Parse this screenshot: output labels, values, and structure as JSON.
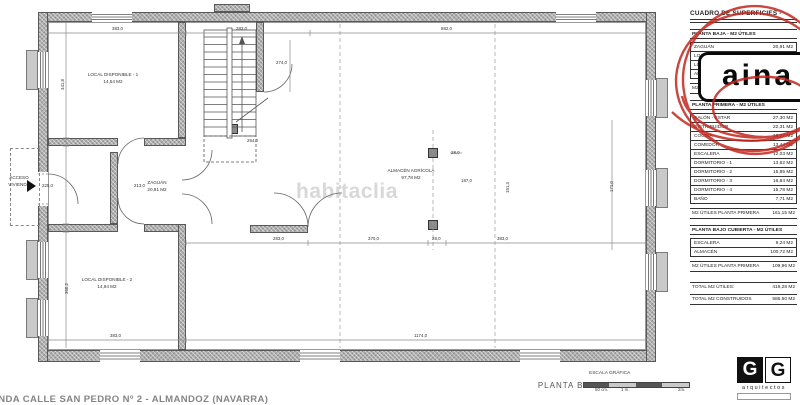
{
  "watermark": "habitaclia",
  "plan": {
    "access": {
      "line1": "ACCESO",
      "line2": "VIVIENDA"
    },
    "rooms": [
      {
        "name": "LOCAL DISPONIBLE - 1",
        "area": "14,54 M2",
        "cx": 113,
        "cy": 72
      },
      {
        "name": "ZAGUÁN",
        "area": "20,91 M2",
        "cx": 157,
        "cy": 180
      },
      {
        "name": "LOCAL DISPONIBLE - 2",
        "area": "14,94 M2",
        "cx": 107,
        "cy": 277
      },
      {
        "name": "ALMACÉN AGRÍCOLA",
        "area": "97,78 M2",
        "cx": 411,
        "cy": 168
      }
    ],
    "dimensions": [
      {
        "t": "383,0",
        "x": 112,
        "y": 26
      },
      {
        "t": "283,0",
        "x": 236,
        "y": 26
      },
      {
        "t": "882,0",
        "x": 441,
        "y": 26
      },
      {
        "t": "274,0",
        "x": 276,
        "y": 60
      },
      {
        "t": "264,0",
        "x": 247,
        "y": 138
      },
      {
        "t": "341,8",
        "x": 60,
        "y": 90,
        "rot": true
      },
      {
        "t": "225,0",
        "x": 42,
        "y": 183
      },
      {
        "t": "213,0",
        "x": 134,
        "y": 183
      },
      {
        "t": "360,2",
        "x": 64,
        "y": 294,
        "rot": true
      },
      {
        "t": "187,0",
        "x": 461,
        "y": 178
      },
      {
        "t": "151,3",
        "x": 505,
        "y": 193,
        "rot": true
      },
      {
        "t": "28,0",
        "x": 451,
        "y": 150
      },
      {
        "t": "283,0",
        "x": 273,
        "y": 236
      },
      {
        "t": "370,0",
        "x": 368,
        "y": 236
      },
      {
        "t": "28,0",
        "x": 432,
        "y": 236
      },
      {
        "t": "383,0",
        "x": 497,
        "y": 236
      },
      {
        "t": "171,0",
        "x": 609,
        "y": 192,
        "rot": true
      },
      {
        "t": "383,0",
        "x": 110,
        "y": 333
      },
      {
        "t": "1174,0",
        "x": 414,
        "y": 333
      }
    ]
  },
  "surface_table": {
    "title": "CUADRO DE SUPERFICIES -",
    "sections": [
      {
        "heading": "PLANTA BAJA - M2 ÚTILES",
        "rows": [
          [
            "ZAGUÁN",
            "20,91 M2"
          ],
          [
            "LOCAL DISPONIBLE 1",
            "14,54 M2"
          ],
          [
            "LOCAL DISPONIBLE 2",
            "14,94 M2"
          ],
          [
            "ALMACÉN AGRÍCOLA",
            "97,78 M2"
          ]
        ],
        "summary": [
          "M2 ÚTILES PLANTA BAJA",
          "148,17 M2"
        ]
      },
      {
        "heading": "PLANTA PRIMERA - M2 ÚTILES",
        "rows": [
          [
            "SALÓN - ESTAR",
            "27,30 M2"
          ],
          [
            "DISTRIBUIDOR",
            "22,31 M2"
          ],
          [
            "COCINA",
            "18,27 M2"
          ],
          [
            "COMEDOR",
            "13,44 M2"
          ],
          [
            "ESCALERA",
            "12,03 M2"
          ],
          [
            "DORMITORIO - 1",
            "13,62 M2"
          ],
          [
            "DORMITORIO - 2",
            "15,85 M2"
          ],
          [
            "DORMITORIO - 3",
            "16,84 M2"
          ],
          [
            "DORMITORIO - 4",
            "15,78 M2"
          ],
          [
            "BAÑO",
            "7,71 M2"
          ]
        ],
        "summary": [
          "M2 ÚTILES PLANTA PRIMERA",
          "161,15 M2"
        ]
      },
      {
        "heading": "PLANTA BAJO CUBIERTA - M2 ÚTILES",
        "rows": [
          [
            "ESCALERA",
            "9,24 M2"
          ],
          [
            "ALMACÉN",
            "100,72 M2"
          ]
        ],
        "summary": [
          "M2 ÚTILES PLANTA PRIMERA",
          "109,96 M2"
        ]
      }
    ],
    "totals": [
      [
        "TOTAL M2 ÚTILES:",
        "419,28 M2"
      ],
      [
        "TOTAL M2 CONSTRUIDOS",
        "586,50 M2"
      ]
    ]
  },
  "stamp": {
    "text": "aina",
    "color": "#c3261d"
  },
  "footer": {
    "plan_title": "PLANTA BAJA",
    "address": "VIVIENDA CALLE SAN PEDRO Nº 2 - ALMANDOZ (NAVARRA)",
    "scale_label": "ESCALA GRÁFICA",
    "scale_ticks": [
      "50 cm.",
      "1 m.",
      "2m."
    ],
    "logo": {
      "letter_left": "G",
      "letter_right": "G",
      "name": "arquitectos"
    }
  }
}
